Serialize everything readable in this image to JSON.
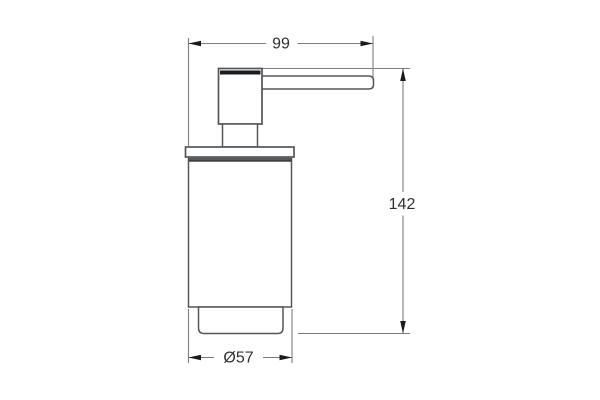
{
  "drawing": {
    "figure": "soap-dispenser-side-elevation",
    "labels": {
      "width": "99",
      "height": "142",
      "diameter": "Ø57"
    },
    "colors": {
      "outline": "#53565a",
      "dim-line": "#7b7d80",
      "arrow": "#1a1b1e",
      "label-text": "#303133",
      "canvas-bg": "#ffffff"
    }
  }
}
